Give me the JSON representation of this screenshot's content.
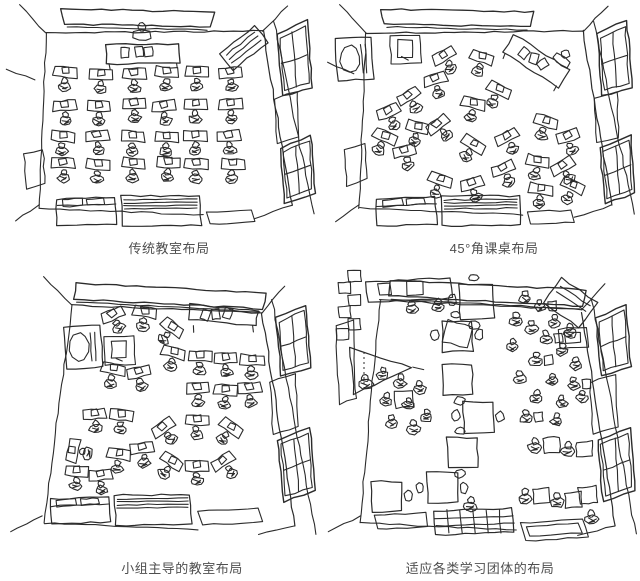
{
  "page": {
    "background": "#ffffff",
    "ink_color": "#2b2b2b",
    "caption_color": "#4f4f4f"
  },
  "figures": [
    {
      "id": "traditional",
      "caption": "传统教室布局"
    },
    {
      "id": "angled",
      "caption": "45°角课桌布局"
    },
    {
      "id": "group",
      "caption": "小组主导的教室布局"
    },
    {
      "id": "adaptive",
      "caption": "适应各类学习团体的布局"
    }
  ]
}
